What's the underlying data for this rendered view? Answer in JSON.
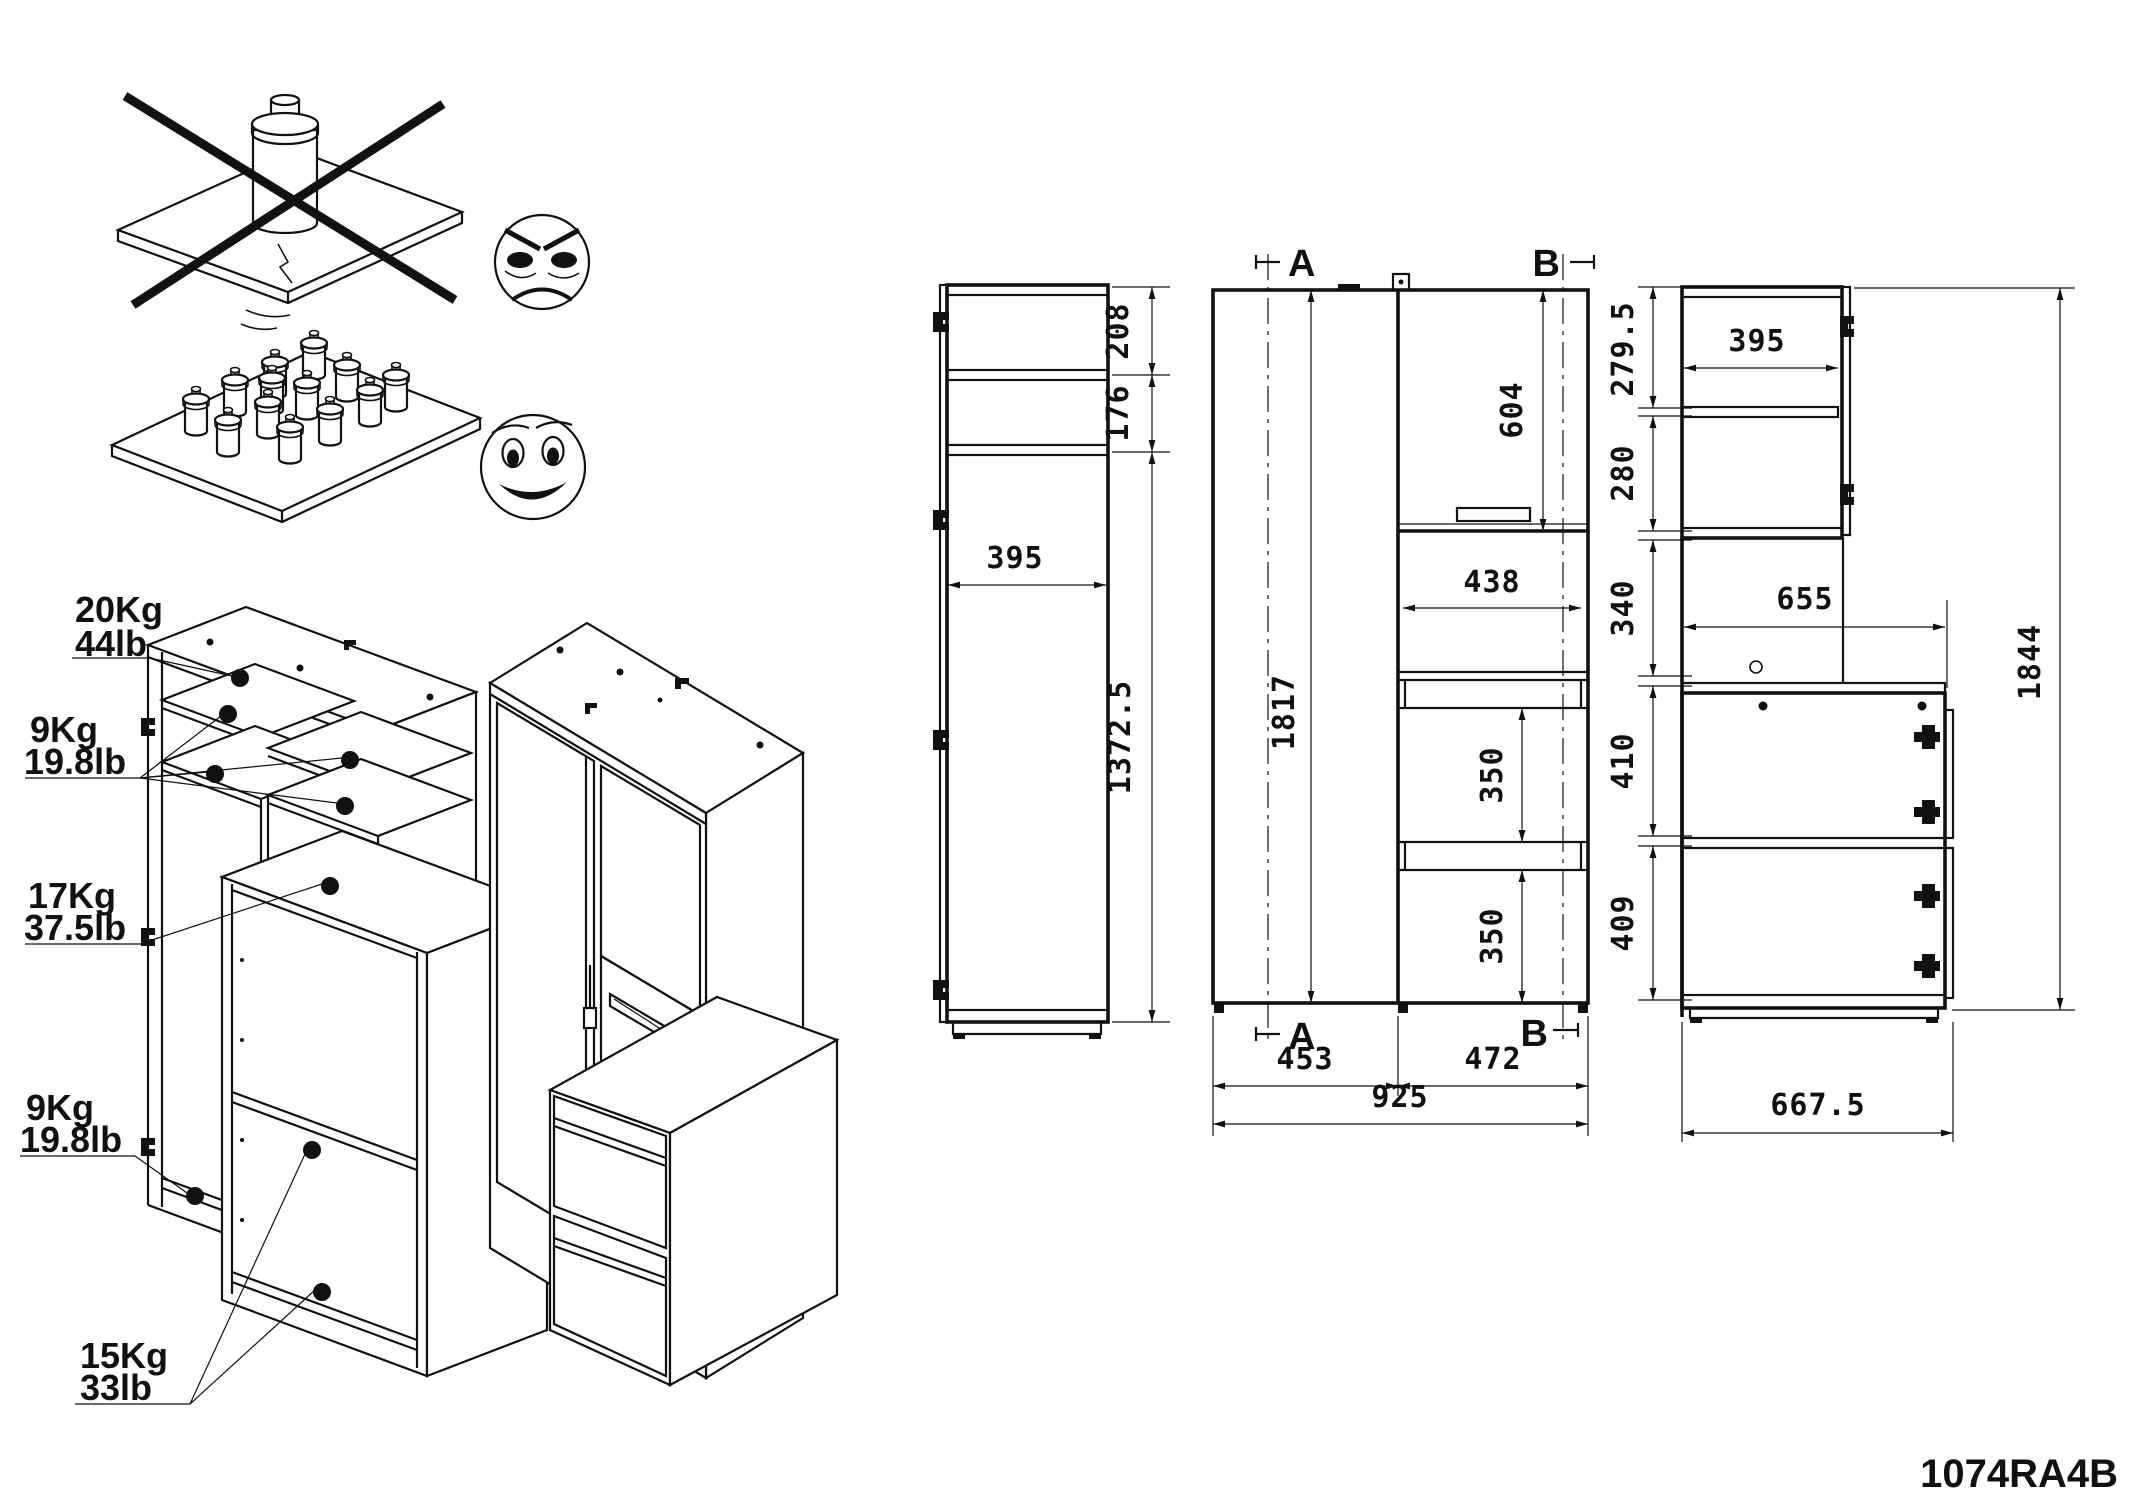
{
  "part_number": "1074RA4B",
  "warnings": {
    "bad_icon": "angry-face-icon",
    "good_icon": "smiley-face-icon"
  },
  "load_labels": [
    {
      "kg": "20Kg",
      "lb": "44lb"
    },
    {
      "kg": "9Kg",
      "lb": "19.8lb"
    },
    {
      "kg": "17Kg",
      "lb": "37.5lb"
    },
    {
      "kg": "9Kg",
      "lb": "19.8lb"
    },
    {
      "kg": "15Kg",
      "lb": "33lb"
    }
  ],
  "side_view": {
    "d_top": "208",
    "d_mid": "176",
    "d_main": "1372.5",
    "width": "395"
  },
  "front_view": {
    "section_left": "A",
    "section_right": "B",
    "height": "1817",
    "door_height": "604",
    "niche_width": "438",
    "gap_upper": "350",
    "gap_lower": "350",
    "width_left": "453",
    "width_right": "472",
    "width_total": "925"
  },
  "right_view": {
    "d1": "279.5",
    "d2": "280",
    "d3": "340",
    "d4": "410",
    "d5": "409",
    "door_width": "395",
    "depth_upper": "655",
    "height_total": "1844",
    "depth_total": "667.5"
  }
}
